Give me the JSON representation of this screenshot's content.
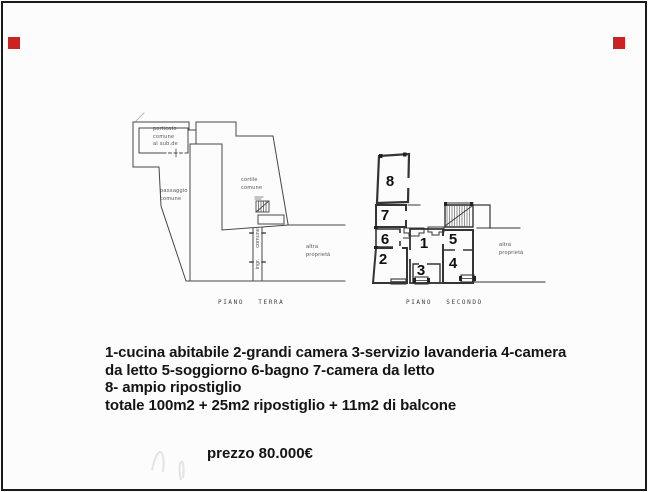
{
  "meta": {
    "background_color": "#fcfcfc",
    "line_color": "#3f3f3f",
    "text_color": "#141414",
    "border_color": "#1a1a1a",
    "corner_marker_color": "#cc2222"
  },
  "floorplans": {
    "terra": {
      "caption": "PIANO TERRA",
      "labels": {
        "porticato": "porticato\ncomune\nal sub.de",
        "passaggio": "passaggio\ncomune",
        "cortile": "cortile\ncomune",
        "altra_proprieta": "altra\nproprietà",
        "comune_vertical": "comune",
        "ingresso": "ingr."
      }
    },
    "secondo": {
      "caption": "PIANO SECONDO",
      "room_numbers": [
        "1",
        "2",
        "3",
        "4",
        "5",
        "6",
        "7",
        "8"
      ],
      "labels": {
        "altra_proprieta": "altra\nproprietà"
      }
    }
  },
  "description": {
    "lines": [
      "1-cucina abitabile 2-grandi camera 3-servizio lavanderia 4-camera",
      "da letto 5-soggiorno 6-bagno 7-camera da letto",
      "8- ampio ripostiglio",
      "totale 100m2 + 25m2 ripostiglio + 11m2 di balcone"
    ]
  },
  "price": "prezzo 80.000€"
}
